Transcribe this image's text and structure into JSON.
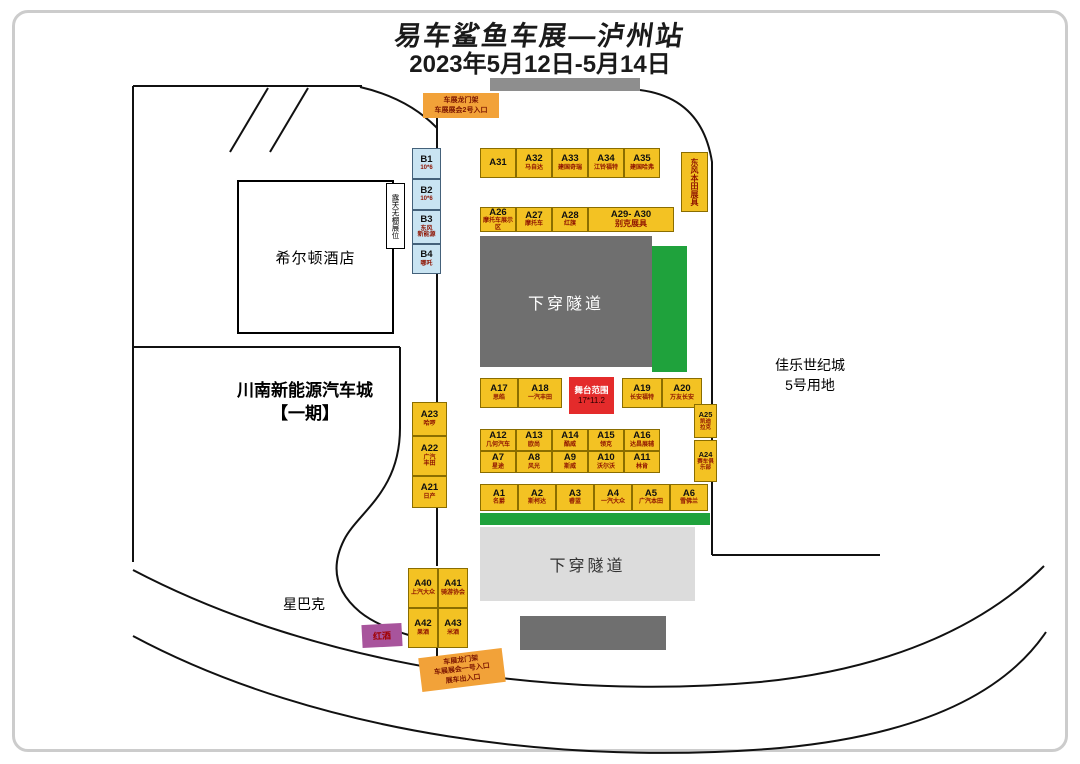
{
  "title": {
    "line1": "易车鲨鱼车展—泸州站",
    "line2": "2023年5月12日-5月14日"
  },
  "landmarks": {
    "hotel": "希尔顿酒店",
    "car_city": "川南新能源汽车城\n【一期】",
    "starbucks": "星巴克",
    "jiale": "佳乐世纪城\n5号用地",
    "tunnel_upper": "下穿隧道",
    "tunnel_lower": "下穿隧道",
    "open_air": "露天无棚展位",
    "dongfeng_honda": "东风本田展具",
    "wine": "红酒"
  },
  "entrances": {
    "top": "车展龙门架\n车展展会2号入口",
    "bottom": "车展龙门架\n车展展会一号入口\n展车出入口"
  },
  "stage": {
    "label": "舞台范围",
    "size": "17*11.2"
  },
  "colors": {
    "booth_yellow": "#f3c223",
    "booth_blue": "#c9e4f2",
    "stage_red": "#e42b2b",
    "green": "#1fa23c",
    "entrance_orange": "#f2a239",
    "wine_purple": "#a8549c"
  },
  "booths": [
    {
      "id": "B1",
      "sub": "10*6"
    },
    {
      "id": "B2",
      "sub": "10*6"
    },
    {
      "id": "B3",
      "sub": "东风\n新能源"
    },
    {
      "id": "B4",
      "sub": "哪吒"
    },
    {
      "id": "A31",
      "sub": ""
    },
    {
      "id": "A32",
      "sub": "马自达"
    },
    {
      "id": "A33",
      "sub": "建国奇瑞"
    },
    {
      "id": "A34",
      "sub": "江铃福特"
    },
    {
      "id": "A35",
      "sub": "建国哈弗"
    },
    {
      "id": "A26",
      "sub": "摩托车展示区"
    },
    {
      "id": "A27",
      "sub": "摩托车"
    },
    {
      "id": "A28",
      "sub": "红旗"
    },
    {
      "id": "A29- A30",
      "sub": "别克展具"
    },
    {
      "id": "A17",
      "sub": "思皓"
    },
    {
      "id": "A18",
      "sub": "一汽丰田"
    },
    {
      "id": "A19",
      "sub": "长安福特"
    },
    {
      "id": "A20",
      "sub": "万友长安"
    },
    {
      "id": "A12",
      "sub": "几何汽车"
    },
    {
      "id": "A13",
      "sub": "欧尚"
    },
    {
      "id": "A14",
      "sub": "酷威"
    },
    {
      "id": "A15",
      "sub": "领克"
    },
    {
      "id": "A16",
      "sub": "达昌展辅"
    },
    {
      "id": "A7",
      "sub": "星途"
    },
    {
      "id": "A8",
      "sub": "风光"
    },
    {
      "id": "A9",
      "sub": "斯威"
    },
    {
      "id": "A10",
      "sub": "沃尔沃"
    },
    {
      "id": "A11",
      "sub": "林肯"
    },
    {
      "id": "A25",
      "sub": "凯迪\n拉克"
    },
    {
      "id": "A24",
      "sub": "赛车俱\n乐部"
    },
    {
      "id": "A23",
      "sub": "哈啰"
    },
    {
      "id": "A22",
      "sub": "广汽\n丰田"
    },
    {
      "id": "A21",
      "sub": "日产"
    },
    {
      "id": "A1",
      "sub": "名爵"
    },
    {
      "id": "A2",
      "sub": "斯柯达"
    },
    {
      "id": "A3",
      "sub": "睿蓝"
    },
    {
      "id": "A4",
      "sub": "一汽大众"
    },
    {
      "id": "A5",
      "sub": "广汽本田"
    },
    {
      "id": "A6",
      "sub": "雪佛兰"
    },
    {
      "id": "A40",
      "sub": "上汽大众"
    },
    {
      "id": "A41",
      "sub": "骑游协会"
    },
    {
      "id": "A42",
      "sub": "果酒"
    },
    {
      "id": "A43",
      "sub": "米酒"
    }
  ]
}
